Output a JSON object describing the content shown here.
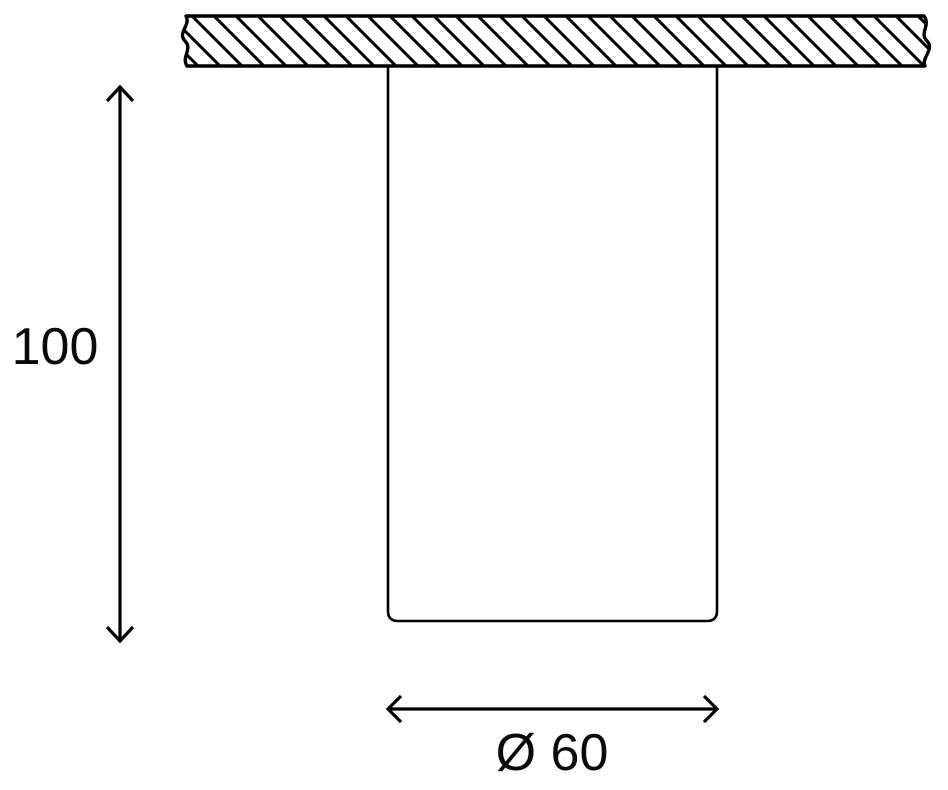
{
  "page": {
    "background_color": "#ffffff",
    "line_color": "#000000"
  },
  "drawing": {
    "labels": {
      "height": "100",
      "diameter": "Ø 60"
    }
  }
}
